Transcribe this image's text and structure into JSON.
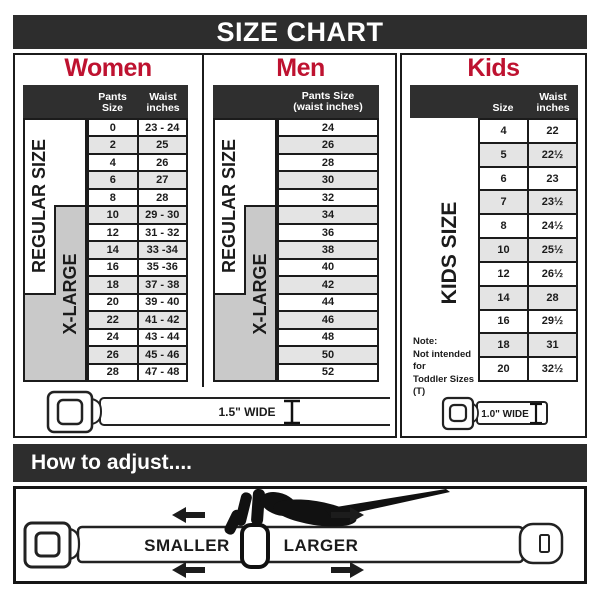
{
  "title_bar": {
    "title": "SIZE CHART"
  },
  "colors": {
    "accent_red": "#BE1230",
    "bar_dark": "#2D2D2D",
    "row_alt": "#E4E4E4",
    "label_gray": "#C9C9C9"
  },
  "women": {
    "heading": "Women",
    "size_labels": {
      "regular": "REGULAR SIZE",
      "xlarge": "X-LARGE"
    },
    "columns": {
      "pants": "Pants Size",
      "waist_line1": "Waist",
      "waist_line2": "inches"
    },
    "rows": [
      [
        "0",
        "23 - 24"
      ],
      [
        "2",
        "25"
      ],
      [
        "4",
        "26"
      ],
      [
        "6",
        "27"
      ],
      [
        "8",
        "28"
      ],
      [
        "10",
        "29 - 30"
      ],
      [
        "12",
        "31 - 32"
      ],
      [
        "14",
        "33 -34"
      ],
      [
        "16",
        "35 -36"
      ],
      [
        "18",
        "37 - 38"
      ],
      [
        "20",
        "39 - 40"
      ],
      [
        "22",
        "41 - 42"
      ],
      [
        "24",
        "43 - 44"
      ],
      [
        "26",
        "45 - 46"
      ],
      [
        "28",
        "47 - 48"
      ]
    ],
    "belt_label": "1.5\" WIDE"
  },
  "men": {
    "heading": "Men",
    "size_labels": {
      "regular": "REGULAR SIZE",
      "xlarge": "X-LARGE"
    },
    "columns": {
      "line1": "Pants Size",
      "line2": "(waist inches)"
    },
    "rows": [
      [
        "24"
      ],
      [
        "26"
      ],
      [
        "28"
      ],
      [
        "30"
      ],
      [
        "32"
      ],
      [
        "34"
      ],
      [
        "36"
      ],
      [
        "38"
      ],
      [
        "40"
      ],
      [
        "42"
      ],
      [
        "44"
      ],
      [
        "46"
      ],
      [
        "48"
      ],
      [
        "50"
      ],
      [
        "52"
      ]
    ]
  },
  "kids": {
    "heading": "Kids",
    "size_label": "KIDS SIZE",
    "columns": {
      "size": "Size",
      "waist_line1": "Waist",
      "waist_line2": "inches"
    },
    "rows": [
      [
        "4",
        "22"
      ],
      [
        "5",
        "22½"
      ],
      [
        "6",
        "23"
      ],
      [
        "7",
        "23½"
      ],
      [
        "8",
        "24½"
      ],
      [
        "10",
        "25½"
      ],
      [
        "12",
        "26½"
      ],
      [
        "14",
        "28"
      ],
      [
        "16",
        "29½"
      ],
      [
        "18",
        "31"
      ],
      [
        "20",
        "32½"
      ]
    ],
    "note": {
      "line1": "Note:",
      "line2": "Not intended for",
      "line3": "Toddler Sizes (T)"
    },
    "belt_label": "1.0\" WIDE"
  },
  "adjust": {
    "heading": "How to adjust....",
    "smaller": "SMALLER",
    "larger": "LARGER"
  }
}
